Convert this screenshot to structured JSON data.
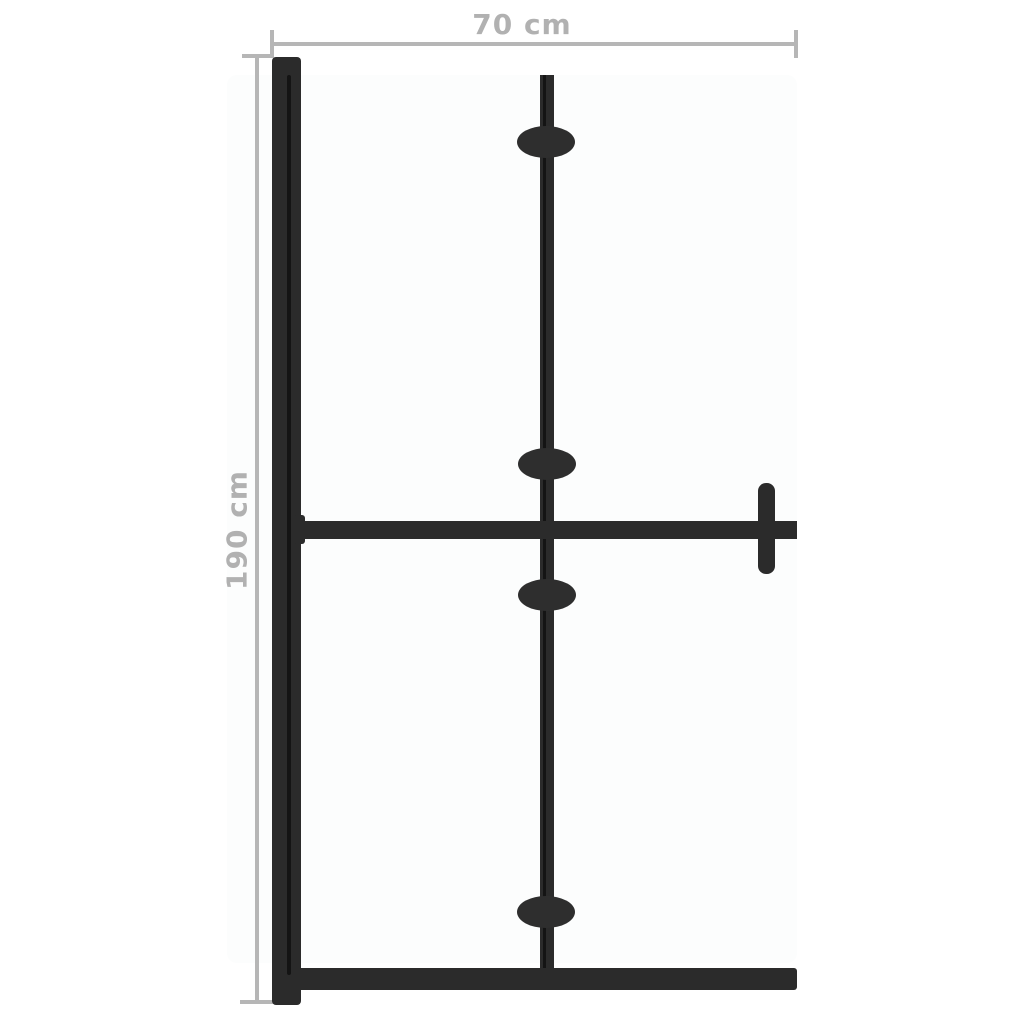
{
  "diagram": {
    "width_label": "70 cm",
    "height_label": "190 cm",
    "hinge_count": 4,
    "colors": {
      "background": "#ffffff",
      "panel_background": "#fcfdfd",
      "frame": "#2b2b2b",
      "frame_inner_edge": "#141414",
      "hinge": "#2e2e2e",
      "dimension_line": "#b6b6b6",
      "dimension_text": "#b1b1b1"
    }
  }
}
